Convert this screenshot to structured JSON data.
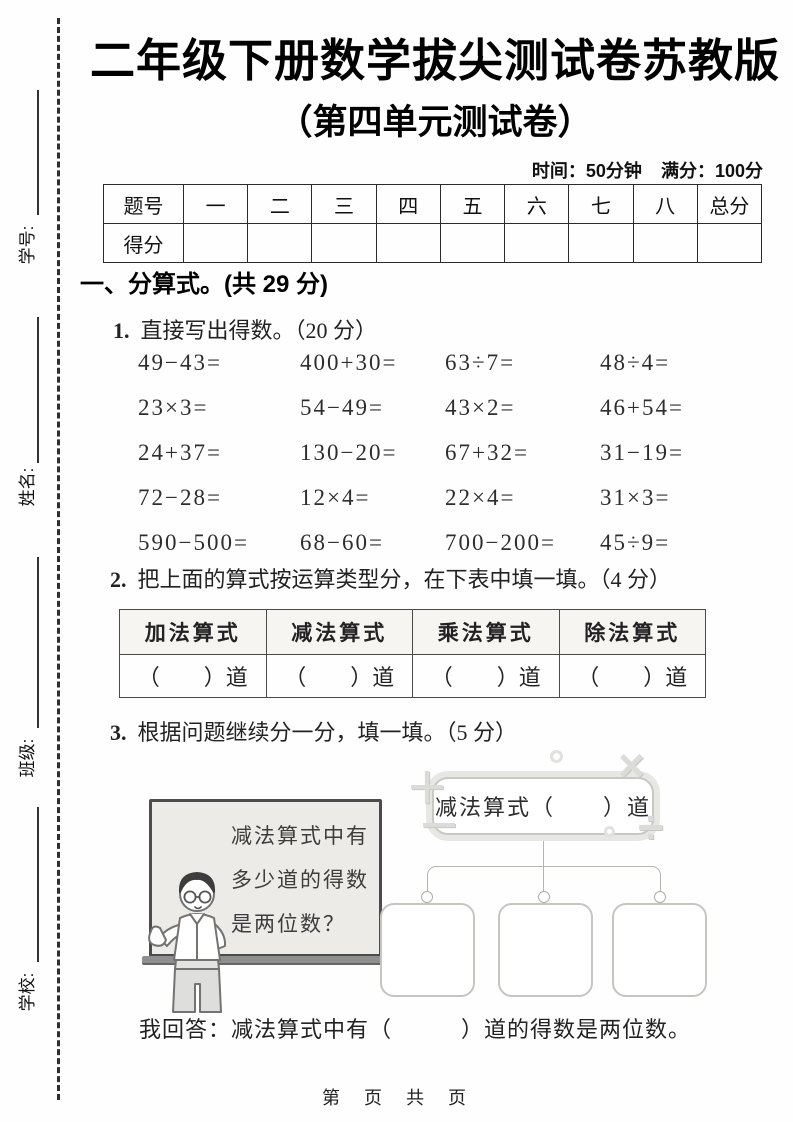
{
  "margin": {
    "labels": [
      "学号:",
      "姓名:",
      "班级:",
      "学校:"
    ]
  },
  "header": {
    "title": "二年级下册数学拔尖测试卷苏教版",
    "subtitle": "（第四单元测试卷）",
    "time_info": "时间：50分钟",
    "score_info": "满分：100分"
  },
  "score_table": {
    "corner": "题号",
    "columns": [
      "一",
      "二",
      "三",
      "四",
      "五",
      "六",
      "七",
      "八",
      "总分"
    ],
    "row_label": "得分"
  },
  "section1": {
    "heading": "一、分算式。(共 29 分)"
  },
  "q1": {
    "num": "1.",
    "text": "直接写出得数。（20 分）",
    "rows": [
      [
        "49−43=",
        "400+30=",
        "63÷7=",
        "48÷4="
      ],
      [
        "23×3=",
        "54−49=",
        "43×2=",
        "46+54="
      ],
      [
        "24+37=",
        "130−20=",
        "67+32=",
        "31−19="
      ],
      [
        "72−28=",
        "12×4=",
        "22×4=",
        "31×3="
      ],
      [
        "590−500=",
        "68−60=",
        "700−200=",
        "45÷9="
      ]
    ]
  },
  "q2": {
    "num": "2.",
    "text": "把上面的算式按运算类型分，在下表中填一填。（4 分）",
    "columns": [
      "加法算式",
      "减法算式",
      "乘法算式",
      "除法算式"
    ],
    "cell_text": "（　　）道"
  },
  "q3": {
    "num": "3.",
    "text": "根据问题继续分一分，填一填。（5 分）",
    "board_line1": "减法算式中有",
    "board_line2": "多少道的得数",
    "board_line3": "是两位数？",
    "top_box_label": "减法算式（　　）道",
    "answer": "我回答：减法算式中有（　　　）道的得数是两位数。"
  },
  "decor": {
    "plus": "＋",
    "minus": "－",
    "times": "×",
    "divide": "÷"
  },
  "footer": "第 页 共 页",
  "colors": {
    "board_bg": "#ecebe8",
    "line_gray": "#b5b5b0",
    "decor_gray": "#dbdbd7",
    "ink": "#1a1a1a"
  }
}
